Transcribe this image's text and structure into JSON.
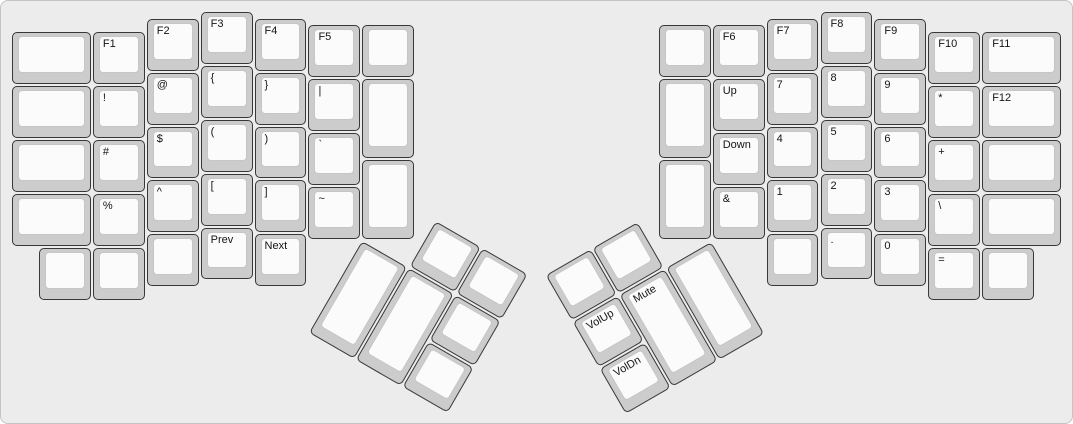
{
  "canvas": {
    "background_color": "#ececec",
    "border_color": "#c4c4c4"
  },
  "key_style": {
    "cap_fill": "#cccccc",
    "cap_border": "#383838",
    "top_fill": "#fbfbfb",
    "top_border": "#c6c6c6",
    "label_color": "#141414"
  },
  "geometry": {
    "unit": 53.9,
    "origin_x": 11,
    "origin_y": 11
  },
  "groups": [
    {
      "name": "left-main",
      "r": 0,
      "rx": 0,
      "ry": 0,
      "keys": [
        {
          "id": "blank",
          "label": "",
          "x": 0,
          "y": 0.375,
          "w": 1.5
        },
        {
          "id": "blank",
          "label": "",
          "x": 0,
          "y": 1.375,
          "w": 1.5
        },
        {
          "id": "blank",
          "label": "",
          "x": 0,
          "y": 2.375,
          "w": 1.5
        },
        {
          "id": "blank",
          "label": "",
          "x": 0,
          "y": 3.375,
          "w": 1.5
        },
        {
          "id": "f1",
          "label": "F1",
          "x": 1.5,
          "y": 0.375
        },
        {
          "id": "exclamation",
          "label": "!",
          "x": 1.5,
          "y": 1.375
        },
        {
          "id": "hash",
          "label": "#",
          "x": 1.5,
          "y": 2.375
        },
        {
          "id": "percent",
          "label": "%",
          "x": 1.5,
          "y": 3.375
        },
        {
          "id": "f2",
          "label": "F2",
          "x": 2.5,
          "y": 0.125
        },
        {
          "id": "at",
          "label": "@",
          "x": 2.5,
          "y": 1.125
        },
        {
          "id": "dollar",
          "label": "$",
          "x": 2.5,
          "y": 2.125
        },
        {
          "id": "caret",
          "label": "^",
          "x": 2.5,
          "y": 3.125
        },
        {
          "id": "f3",
          "label": "F3",
          "x": 3.5,
          "y": 0
        },
        {
          "id": "brace-open",
          "label": "{",
          "x": 3.5,
          "y": 1
        },
        {
          "id": "paren-open",
          "label": "(",
          "x": 3.5,
          "y": 2
        },
        {
          "id": "bracket-open",
          "label": "[",
          "x": 3.5,
          "y": 3
        },
        {
          "id": "f4",
          "label": "F4",
          "x": 4.5,
          "y": 0.125
        },
        {
          "id": "brace-close",
          "label": "}",
          "x": 4.5,
          "y": 1.125
        },
        {
          "id": "paren-close",
          "label": ")",
          "x": 4.5,
          "y": 2.125
        },
        {
          "id": "bracket-close",
          "label": "]",
          "x": 4.5,
          "y": 3.125
        },
        {
          "id": "f5",
          "label": "F5",
          "x": 5.5,
          "y": 0.25
        },
        {
          "id": "pipe",
          "label": "|",
          "x": 5.5,
          "y": 1.25
        },
        {
          "id": "backtick",
          "label": "`",
          "x": 5.5,
          "y": 2.25
        },
        {
          "id": "tilde",
          "label": "~",
          "x": 5.5,
          "y": 3.25
        },
        {
          "id": "blank",
          "label": "",
          "x": 6.5,
          "y": 0.25
        },
        {
          "id": "blank",
          "label": "",
          "x": 6.5,
          "y": 1.25,
          "h": 1.5
        },
        {
          "id": "blank",
          "label": "",
          "x": 6.5,
          "y": 2.75,
          "h": 1.5
        },
        {
          "id": "blank",
          "label": "",
          "x": 0.5,
          "y": 4.375
        },
        {
          "id": "blank",
          "label": "",
          "x": 1.5,
          "y": 4.375
        },
        {
          "id": "blank",
          "label": "",
          "x": 2.5,
          "y": 4.125
        },
        {
          "id": "prev",
          "label": "Prev",
          "x": 3.5,
          "y": 4
        },
        {
          "id": "next",
          "label": "Next",
          "x": 4.5,
          "y": 4.125
        }
      ]
    },
    {
      "name": "right-main",
      "r": 0,
      "rx": 0,
      "ry": 0,
      "keys": [
        {
          "id": "blank",
          "label": "",
          "x": 12,
          "y": 0.25
        },
        {
          "id": "blank",
          "label": "",
          "x": 12,
          "y": 1.25,
          "h": 1.5
        },
        {
          "id": "blank",
          "label": "",
          "x": 12,
          "y": 2.75,
          "h": 1.5
        },
        {
          "id": "f6",
          "label": "F6",
          "x": 13,
          "y": 0.25
        },
        {
          "id": "up",
          "label": "Up",
          "x": 13,
          "y": 1.25
        },
        {
          "id": "down",
          "label": "Down",
          "x": 13,
          "y": 2.25
        },
        {
          "id": "ampersand",
          "label": "&",
          "x": 13,
          "y": 3.25
        },
        {
          "id": "f7",
          "label": "F7",
          "x": 14,
          "y": 0.125
        },
        {
          "id": "num-7",
          "label": "7",
          "x": 14,
          "y": 1.125
        },
        {
          "id": "num-4",
          "label": "4",
          "x": 14,
          "y": 2.125
        },
        {
          "id": "num-1",
          "label": "1",
          "x": 14,
          "y": 3.125
        },
        {
          "id": "f8",
          "label": "F8",
          "x": 15,
          "y": 0
        },
        {
          "id": "num-8",
          "label": "8",
          "x": 15,
          "y": 1
        },
        {
          "id": "num-5",
          "label": "5",
          "x": 15,
          "y": 2
        },
        {
          "id": "num-2",
          "label": "2",
          "x": 15,
          "y": 3
        },
        {
          "id": "f9",
          "label": "F9",
          "x": 16,
          "y": 0.125
        },
        {
          "id": "num-9",
          "label": "9",
          "x": 16,
          "y": 1.125
        },
        {
          "id": "num-6",
          "label": "6",
          "x": 16,
          "y": 2.125
        },
        {
          "id": "num-3",
          "label": "3",
          "x": 16,
          "y": 3.125
        },
        {
          "id": "f10",
          "label": "F10",
          "x": 17,
          "y": 0.375
        },
        {
          "id": "asterisk",
          "label": "*",
          "x": 17,
          "y": 1.375
        },
        {
          "id": "plus",
          "label": "+",
          "x": 17,
          "y": 2.375
        },
        {
          "id": "backslash",
          "label": "\\",
          "x": 17,
          "y": 3.375
        },
        {
          "id": "f11",
          "label": "F11",
          "x": 18,
          "y": 0.375,
          "w": 1.5
        },
        {
          "id": "f12",
          "label": "F12",
          "x": 18,
          "y": 1.375,
          "w": 1.5
        },
        {
          "id": "blank",
          "label": "",
          "x": 18,
          "y": 2.375,
          "w": 1.5
        },
        {
          "id": "blank",
          "label": "",
          "x": 18,
          "y": 3.375,
          "w": 1.5
        },
        {
          "id": "blank",
          "label": "",
          "x": 14,
          "y": 4.125
        },
        {
          "id": "period",
          "label": ".",
          "x": 15,
          "y": 4
        },
        {
          "id": "num-0",
          "label": "0",
          "x": 16,
          "y": 4.125
        },
        {
          "id": "equals",
          "label": "=",
          "x": 17,
          "y": 4.375
        },
        {
          "id": "blank",
          "label": "",
          "x": 18,
          "y": 4.375
        }
      ]
    },
    {
      "name": "left-thumb",
      "r": 30,
      "rx": 6.5,
      "ry": 4.25,
      "keys": [
        {
          "id": "blank",
          "label": "",
          "x": 1,
          "y": -1
        },
        {
          "id": "blank",
          "label": "",
          "x": 2,
          "y": -1
        },
        {
          "id": "blank",
          "label": "",
          "x": 0,
          "y": 0,
          "h": 2
        },
        {
          "id": "blank",
          "label": "",
          "x": 1,
          "y": 0,
          "h": 2
        },
        {
          "id": "blank",
          "label": "",
          "x": 2,
          "y": 0
        },
        {
          "id": "blank",
          "label": "",
          "x": 2,
          "y": 1
        }
      ]
    },
    {
      "name": "right-thumb",
      "r": -30,
      "rx": 13,
      "ry": 4.25,
      "keys": [
        {
          "id": "blank",
          "label": "",
          "x": -3,
          "y": -1
        },
        {
          "id": "blank",
          "label": "",
          "x": -2,
          "y": -1
        },
        {
          "id": "vol-up",
          "label": "VolUp",
          "x": -3,
          "y": 0
        },
        {
          "id": "mute",
          "label": "Mute",
          "x": -2,
          "y": 0,
          "h": 2
        },
        {
          "id": "blank",
          "label": "",
          "x": -1,
          "y": 0,
          "h": 2
        },
        {
          "id": "vol-dn",
          "label": "VolDn",
          "x": -3,
          "y": 1
        }
      ]
    }
  ]
}
